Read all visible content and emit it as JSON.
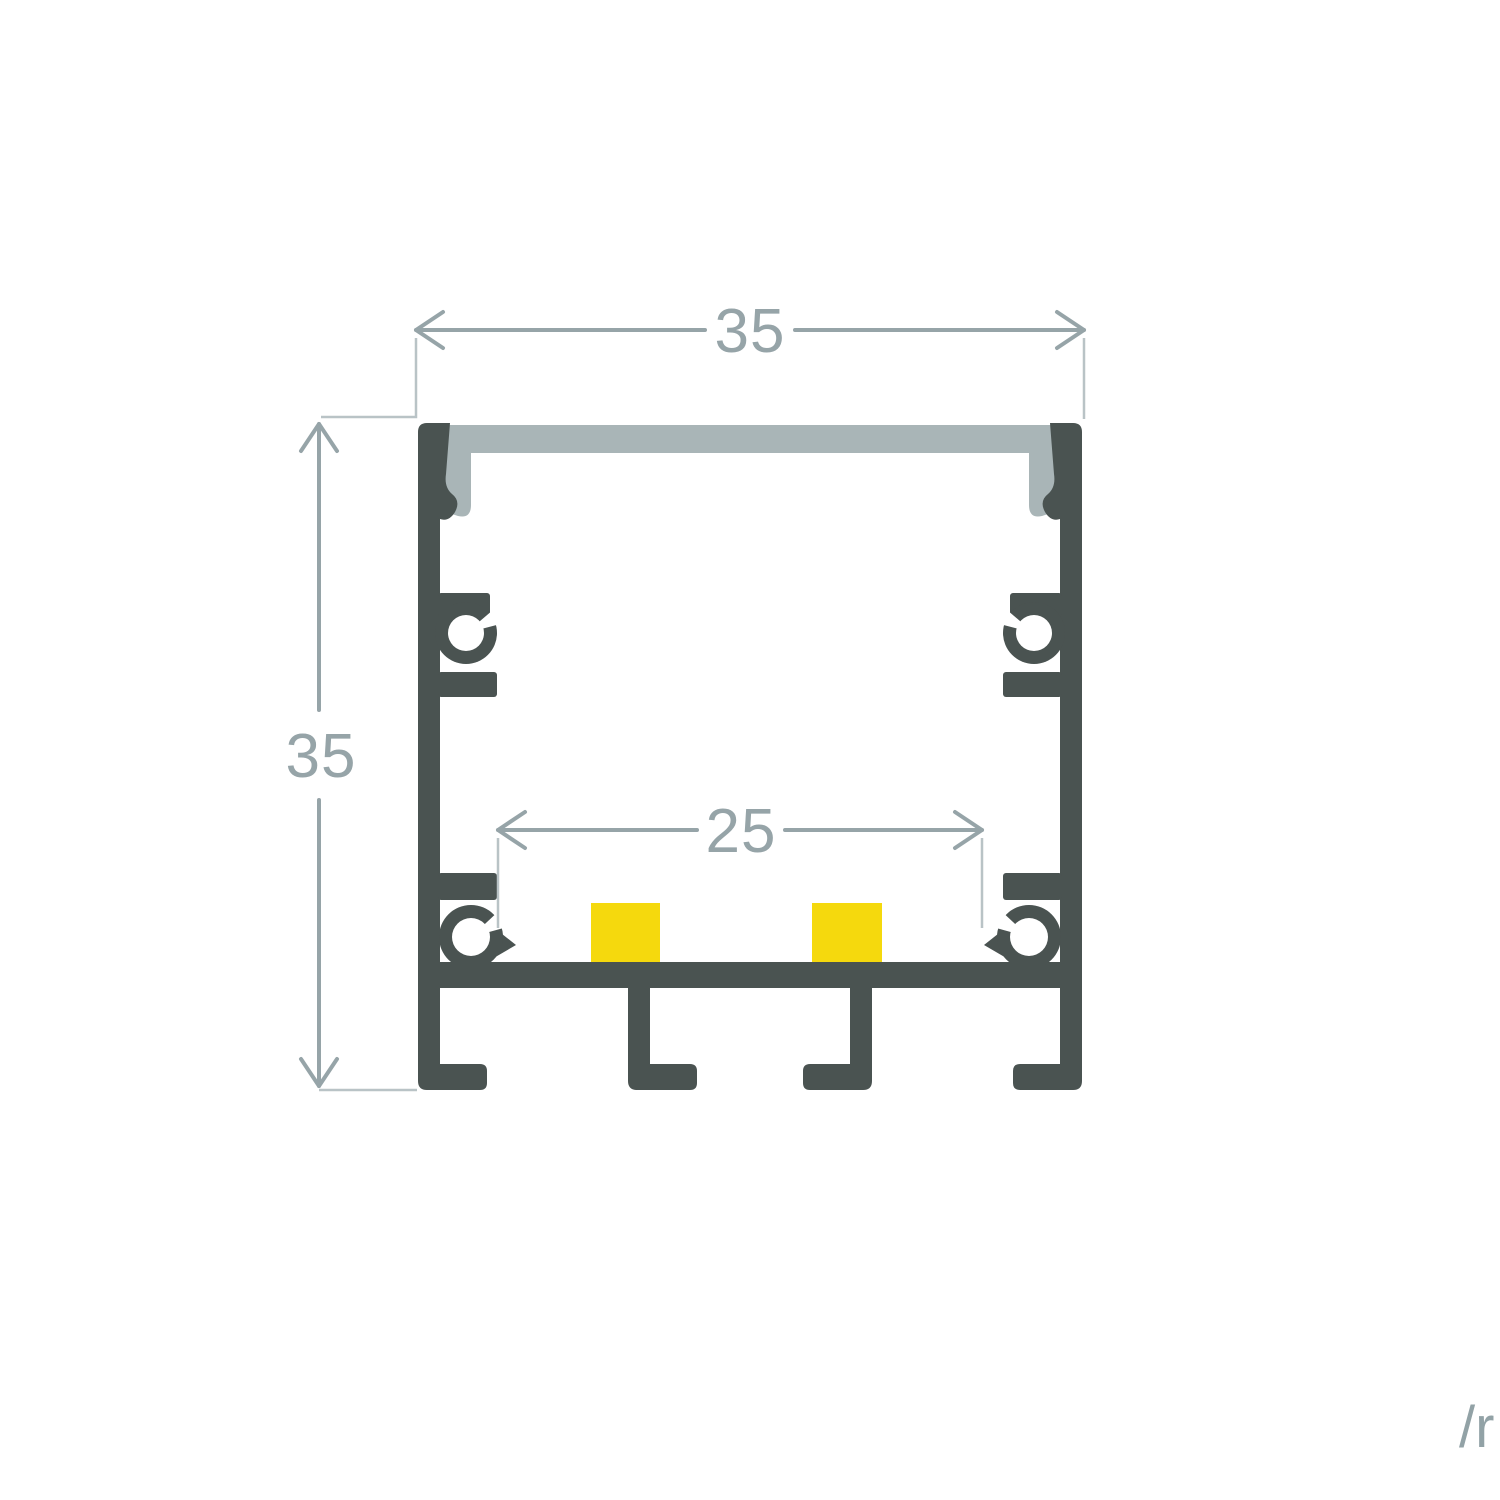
{
  "diagram": {
    "title": "aluminium-led-profile-cross-section",
    "dimension_top": {
      "value": "35"
    },
    "dimension_left": {
      "value": "35"
    },
    "dimension_inner": {
      "value": "25"
    },
    "watermark": "/r",
    "colors": {
      "profile_body": "#4a5351",
      "diffuser": "#a9b5b7",
      "led_strip": "#f5d90d",
      "dimension_lines": "#96a4a8",
      "extension_lines": "#b9c3c6",
      "watermark_text": "#92a2a6",
      "background": "#ffffff"
    }
  }
}
